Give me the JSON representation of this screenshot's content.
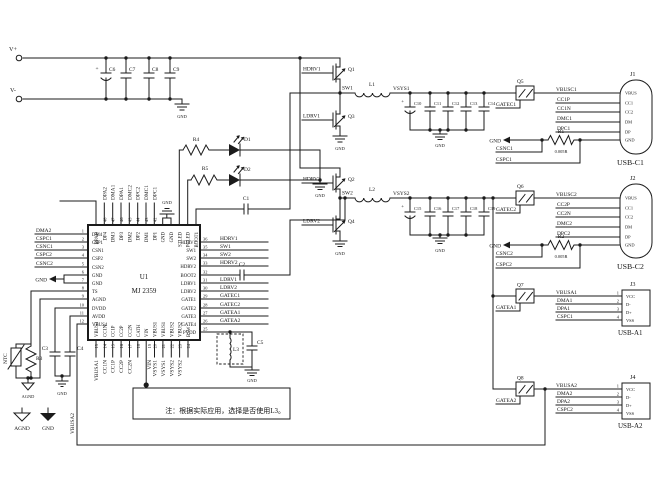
{
  "power": {
    "vplus": "V+",
    "vminus": "V-",
    "gnd": "GND",
    "agnd": "AGND",
    "plus": "+"
  },
  "note": "注：根据实际应用，选择是否使用L3。",
  "input_caps": {
    "c6": "C6",
    "c7": "C7",
    "c8": "C8",
    "c9": "C9"
  },
  "ic": {
    "ref": "U1",
    "part": "MJ 2359",
    "left": [
      {
        "num": "1",
        "name": "DM4",
        "net": "DMA2"
      },
      {
        "num": "2",
        "name": "CSP1",
        "net": "CSPC1"
      },
      {
        "num": "3",
        "name": "CSN1",
        "net": "CSNC1"
      },
      {
        "num": "4",
        "name": "CSP2",
        "net": "CSPC2"
      },
      {
        "num": "5",
        "name": "CSN2",
        "net": "CSNC2"
      },
      {
        "num": "6",
        "name": "GND",
        "net": ""
      },
      {
        "num": "7",
        "name": "GND",
        "net": ""
      },
      {
        "num": "8",
        "name": "TS",
        "net": ""
      },
      {
        "num": "9",
        "name": "AGND",
        "net": ""
      },
      {
        "num": "10",
        "name": "DVDD",
        "net": ""
      },
      {
        "num": "11",
        "name": "AVDD",
        "net": ""
      },
      {
        "num": "12",
        "name": "VBUS4",
        "net": ""
      }
    ],
    "top": [
      {
        "num": "",
        "name": "BPAD",
        "net": ""
      },
      {
        "num": "48",
        "name": "DP4",
        "net": "DPA2"
      },
      {
        "num": "47",
        "name": "DM3",
        "net": "DMA1"
      },
      {
        "num": "46",
        "name": "DP3",
        "net": "DPA1"
      },
      {
        "num": "45",
        "name": "DM2",
        "net": "DMC2"
      },
      {
        "num": "44",
        "name": "DP2",
        "net": "DPC2"
      },
      {
        "num": "43",
        "name": "DM1",
        "net": "DMC1"
      },
      {
        "num": "42",
        "name": "DP1",
        "net": "DPC1"
      },
      {
        "num": "41",
        "name": "GND",
        "net": ""
      },
      {
        "num": "40",
        "name": "GND",
        "net": ""
      },
      {
        "num": "39",
        "name": "STLED",
        "net": ""
      },
      {
        "num": "38",
        "name": "PCLED",
        "net": ""
      },
      {
        "num": "37",
        "name": "BOOT1",
        "net": ""
      }
    ],
    "right": [
      {
        "num": "36",
        "name": "HDRV1",
        "net": "HDRV1"
      },
      {
        "num": "35",
        "name": "SW1",
        "net": "SW1"
      },
      {
        "num": "34",
        "name": "SW2",
        "net": "SW2"
      },
      {
        "num": "33",
        "name": "HDRV2",
        "net": "HDRV2"
      },
      {
        "num": "32",
        "name": "BOOT2",
        "net": ""
      },
      {
        "num": "31",
        "name": "LDRV1",
        "net": "LDRV1"
      },
      {
        "num": "30",
        "name": "LDRV2",
        "net": "LDRV2"
      },
      {
        "num": "29",
        "name": "GATE1",
        "net": "GATEC1"
      },
      {
        "num": "28",
        "name": "GATE2",
        "net": "GATEC2"
      },
      {
        "num": "27",
        "name": "GATE3",
        "net": "GATEA1"
      },
      {
        "num": "26",
        "name": "GATE4",
        "net": "GATEA2"
      },
      {
        "num": "25",
        "name": "PVDD",
        "net": ""
      }
    ],
    "bottom": [
      {
        "num": "13",
        "name": "VBUS3",
        "net": "VBUSA1"
      },
      {
        "num": "14",
        "name": "CC1N",
        "net": "CC1N"
      },
      {
        "num": "15",
        "name": "CC1P",
        "net": "CC1P"
      },
      {
        "num": "16",
        "name": "CC2P",
        "net": "CC2P"
      },
      {
        "num": "17",
        "name": "CC2N",
        "net": "CC2N"
      },
      {
        "num": "18",
        "name": "CATH",
        "net": ""
      },
      {
        "num": "19",
        "name": "VIN",
        "net": "VIN"
      },
      {
        "num": "20",
        "name": "VBUS1",
        "net": "VSYS1"
      },
      {
        "num": "21",
        "name": "VBUS1",
        "net": "VSYS1"
      },
      {
        "num": "22",
        "name": "VBUS2",
        "net": "VSYS2"
      },
      {
        "num": "23",
        "name": "VBUS2",
        "net": "VSYS2"
      },
      {
        "num": "24",
        "name": "BSW",
        "net": ""
      }
    ]
  },
  "buck1": {
    "q_high": "Q1",
    "q_low": "Q3",
    "hdrv": "HDRV1",
    "ldrv": "LDRV1",
    "sw": "SW1",
    "l": "L1",
    "vsys": "VSYS1",
    "caps": {
      "c10": "C10",
      "c11": "C11",
      "c12": "C12",
      "c13": "C13",
      "c14": "C14"
    }
  },
  "buck2": {
    "q_high": "Q2",
    "q_low": "Q4",
    "hdrv": "HDRV2",
    "ldrv": "LDRV2",
    "sw": "SW2",
    "l": "L2",
    "vsys": "VSYS2",
    "caps": {
      "c15": "C15",
      "c16": "C16",
      "c17": "C17",
      "c18": "C18",
      "c19": "C19"
    }
  },
  "leds": {
    "r4": "R4",
    "d1": "D1",
    "r5": "R5",
    "d2": "D2"
  },
  "boot": {
    "c1": "C1",
    "c2": "C2"
  },
  "outfilter": {
    "l3": "L3",
    "c5": "C5"
  },
  "ntc": {
    "name": "NTC",
    "r3": "R3",
    "c3": "C3",
    "c4": "C4"
  },
  "vbus4_route": "VBUSA2",
  "portc1": {
    "q": "Q5",
    "gate": "GATEC1",
    "vbus": "VBUSC1",
    "ccp": "CC1P",
    "ccn": "CC1N",
    "dm": "DMC1",
    "dp": "DPC1",
    "r": "R1",
    "rval": "0.005R",
    "csn": "CSNC1",
    "csp": "CSPC1",
    "conn": {
      "ref": "J1",
      "label": "USB-C1",
      "p1": "VBUS",
      "p2": "CC1",
      "p3": "CC2",
      "p4": "DM",
      "p5": "DP",
      "p6": "GND"
    }
  },
  "portc2": {
    "q": "Q6",
    "gate": "GATEC2",
    "vbus": "VBUSC2",
    "ccp": "CC2P",
    "ccn": "CC2N",
    "dm": "DMC2",
    "dp": "DPC2",
    "r": "R2",
    "rval": "0.005R",
    "csn": "CSNC2",
    "csp": "CSPC2",
    "conn": {
      "ref": "J2",
      "label": "USB-C2",
      "p1": "VBUS",
      "p2": "CC1",
      "p3": "CC2",
      "p4": "DM",
      "p5": "DP",
      "p6": "GND"
    }
  },
  "porta1": {
    "q": "Q7",
    "gate": "GATEA1",
    "vbus": "VBUSA1",
    "dm": "DMA1",
    "dp": "DPA1",
    "gndnet": "CSPC1",
    "conn": {
      "ref": "J3",
      "label": "USB-A1",
      "p1": "VCC",
      "p2": "D-",
      "p3": "D+",
      "p4": "VSS",
      "n1": "1",
      "n2": "2",
      "n3": "3",
      "n4": "4"
    }
  },
  "porta2": {
    "q": "Q8",
    "gate": "GATEA2",
    "vbus": "VBUSA2",
    "dm": "DMA2",
    "dp": "DPA2",
    "gndnet": "CSPC2",
    "conn": {
      "ref": "J4",
      "label": "USB-A2",
      "p1": "VCC",
      "p2": "D-",
      "p3": "D+",
      "p4": "VSS",
      "n1": "1",
      "n2": "2",
      "n3": "3",
      "n4": "4"
    }
  }
}
